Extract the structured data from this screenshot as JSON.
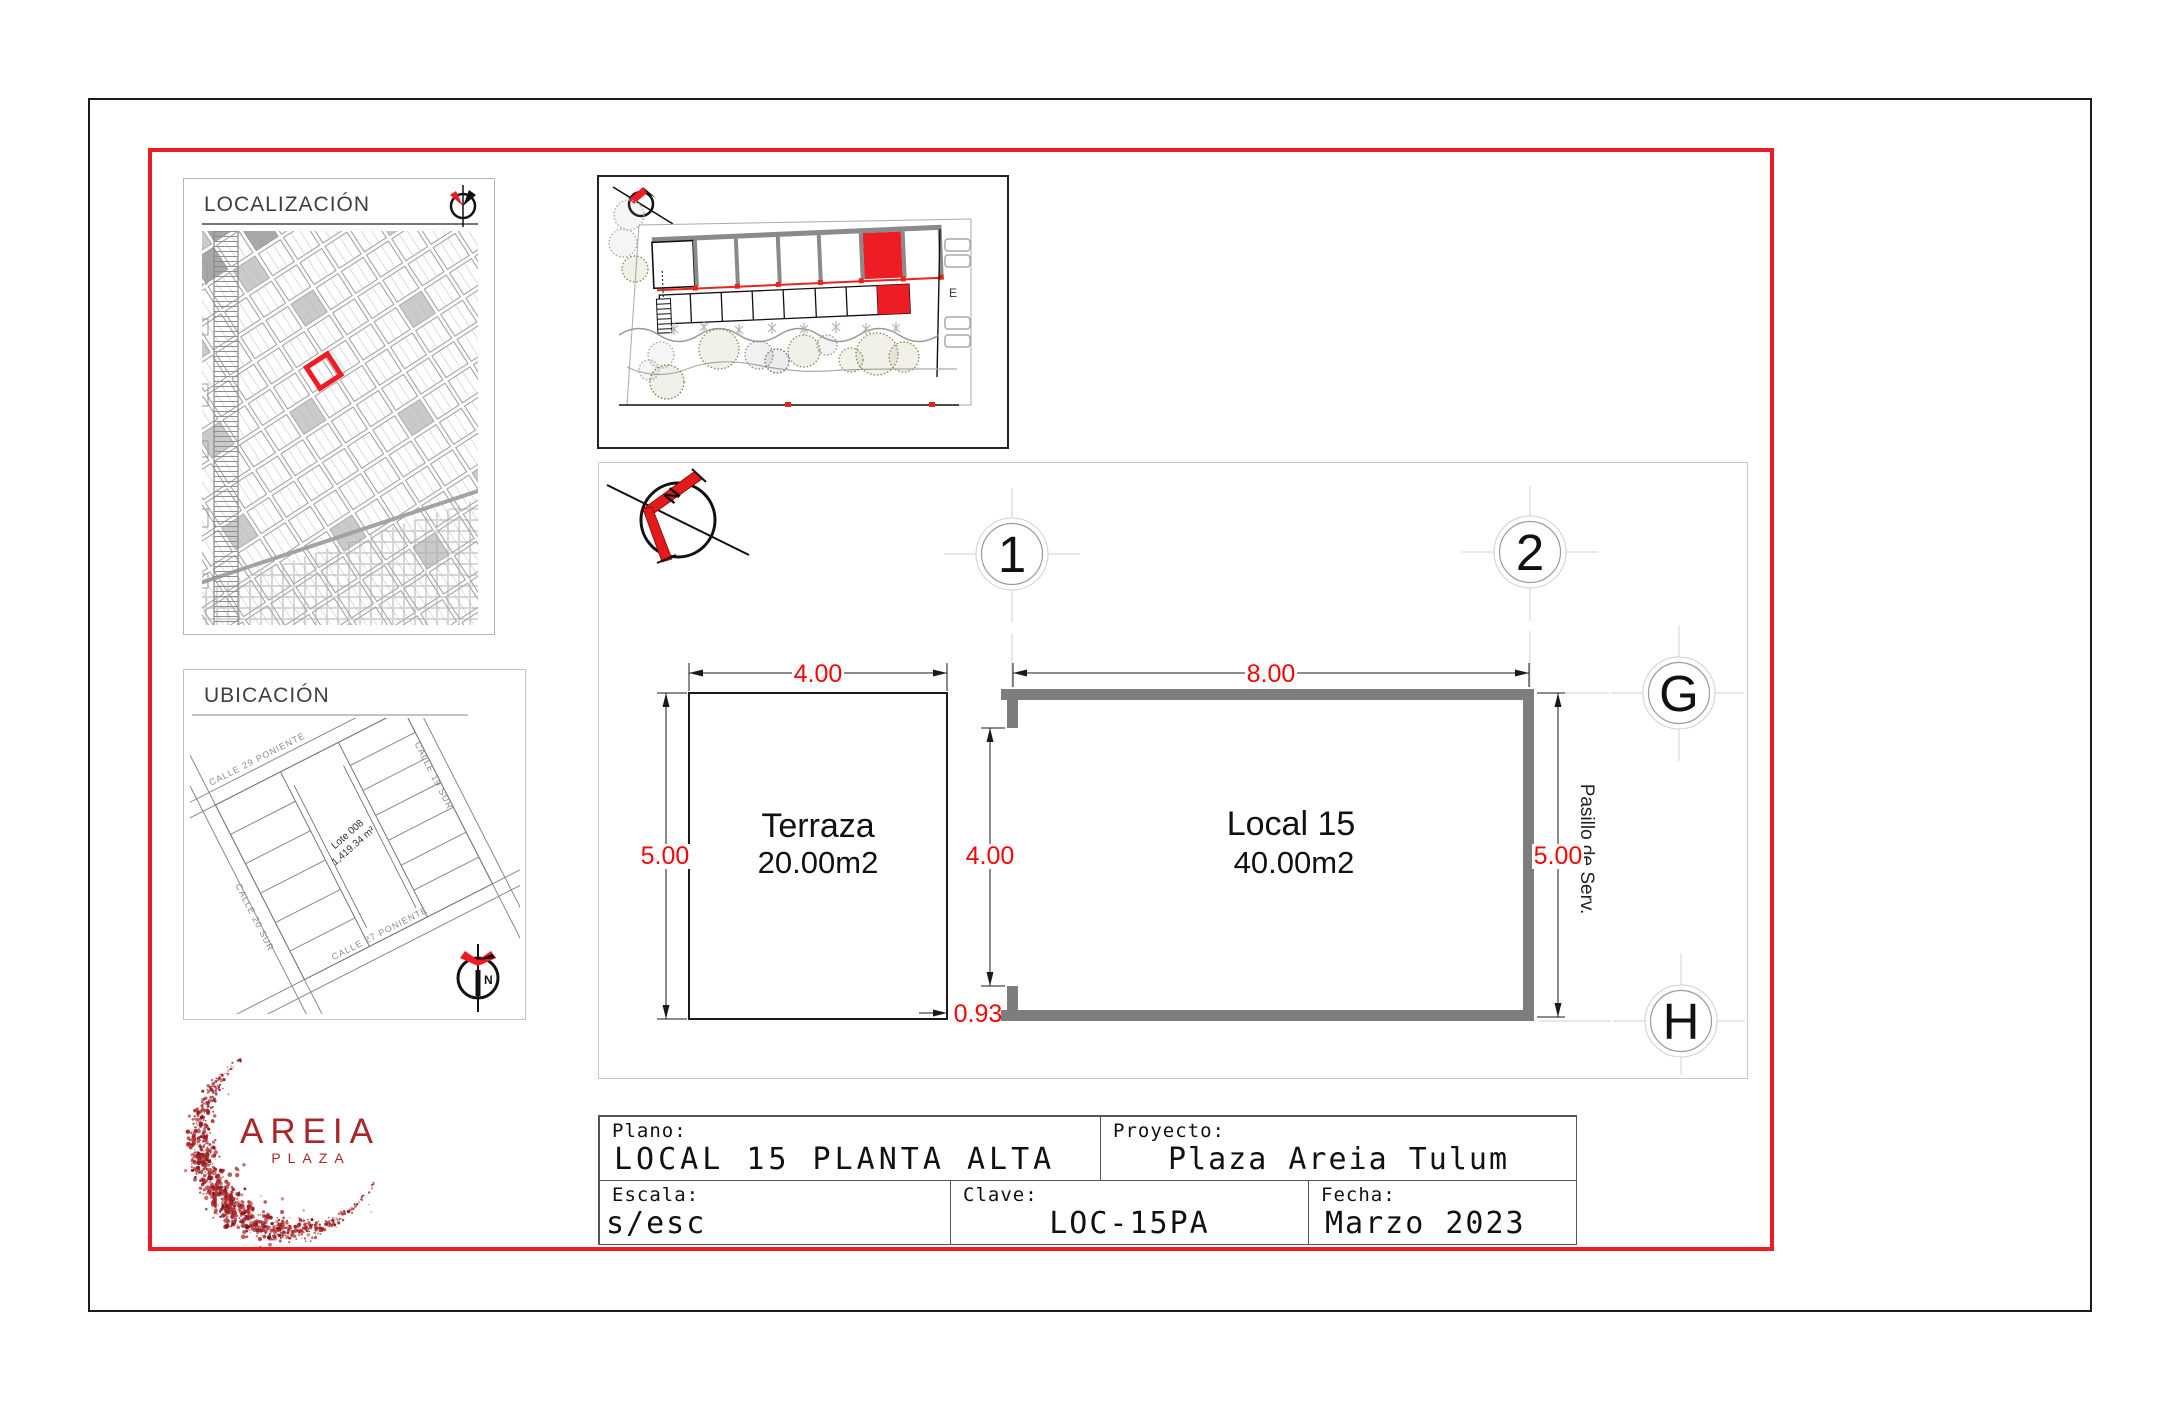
{
  "colors": {
    "frame_red": "#ed1c24",
    "dim_red": "#f60505",
    "wall_gray": "#7d7d7d",
    "logo_red": "#a8262c"
  },
  "localizacion": {
    "title": "LOCALIZACIÓN"
  },
  "ubicacion": {
    "title": "UBICACIÓN",
    "street_top": "CALLE 29 PONIENTE",
    "street_right": "CALLE 19 SUR",
    "street_left": "CALLE 20 SUR",
    "street_bottom": "CALLE 27 PONIENTE",
    "lot_name": "Lote 008",
    "lot_area": "1,419.34 m²",
    "north": "N"
  },
  "siteplan": {
    "zone_label": "E"
  },
  "plan": {
    "north": "N",
    "bubble_1": "1",
    "bubble_2": "2",
    "bubble_g": "G",
    "bubble_h": "H",
    "terraza_name": "Terraza",
    "terraza_area": "20.00m2",
    "local_name": "Local 15",
    "local_area": "40.00m2",
    "corridor": "Pasillo de Serv.",
    "dim_terraza_width": "4.00",
    "dim_terraza_height": "5.00",
    "dim_local_width": "8.00",
    "dim_opening": "4.00",
    "dim_local_height": "5.00",
    "dim_offset": "0.93"
  },
  "logo": {
    "brand": "AREIA",
    "sub": "PLAZA"
  },
  "titleblock": {
    "plano_label": "Plano:",
    "plano_value": "LOCAL 15 PLANTA ALTA",
    "proyecto_label": "Proyecto:",
    "proyecto_value": "Plaza Areia Tulum",
    "escala_label": "Escala:",
    "escala_value": "s/esc",
    "clave_label": "Clave:",
    "clave_value": "LOC-15PA",
    "fecha_label": "Fecha:",
    "fecha_value": "Marzo 2023"
  }
}
